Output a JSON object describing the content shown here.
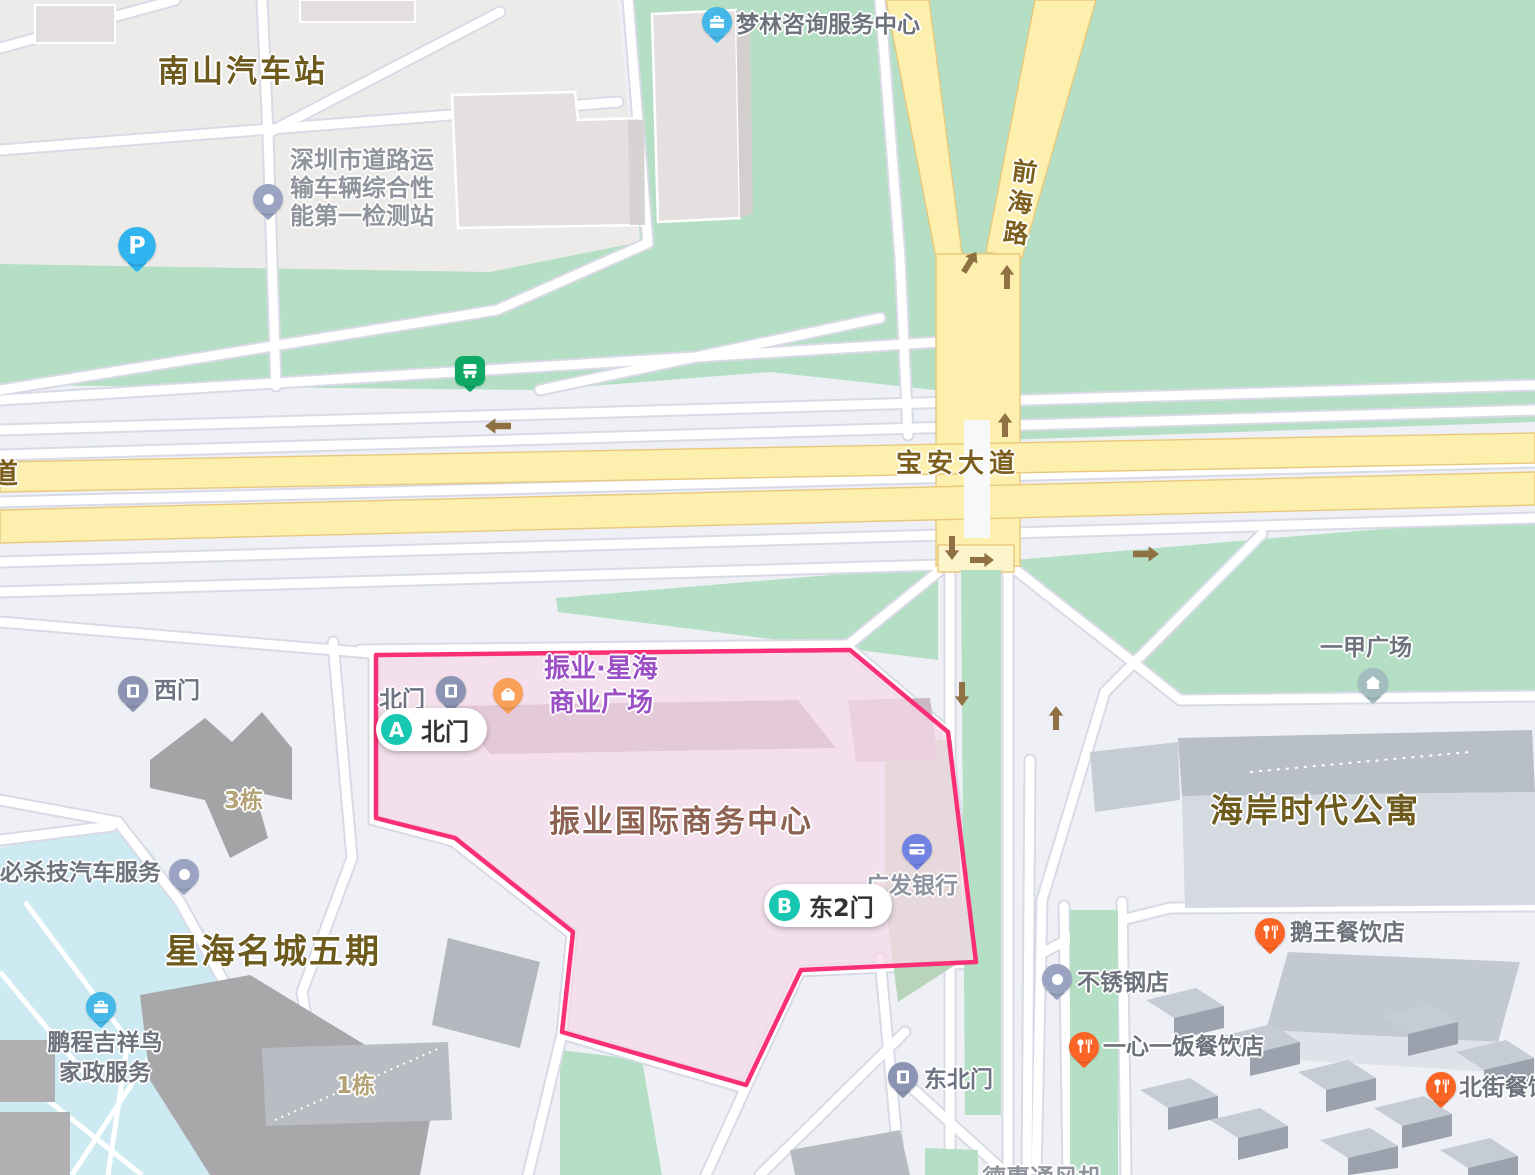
{
  "colors": {
    "polygon_stroke": "#fb2f75",
    "polygon_fill": "#f6d9e7",
    "green": "#b5dfc4",
    "road_yellow": "#fdf0ae",
    "teal_marker": "#17c7b2",
    "water": "#cde9f2"
  },
  "map": {
    "area_labels": {
      "nanshan_bus_station": "南山汽车站",
      "xinghai_mingcheng_phase5": "星海名城五期",
      "haian_times_apartment": "海岸时代公寓",
      "zhenye_intl_business_center": "振业国际商务中心",
      "yijia_plaza": "一甲广场",
      "building_3": "3栋",
      "building_1": "1栋"
    },
    "road_labels": {
      "baoan_avenue": "宝安大道",
      "qianhai_road": "前海路",
      "partial_left_edge": "道"
    },
    "poi_labels": {
      "menglin": "梦林咨询服务中心",
      "inspection_line1": "深圳市道路运",
      "inspection_line2": "输车辆综合性",
      "inspection_line3": "能第一检测站",
      "zhenye_xinghai_line1": "振业·星海",
      "zhenye_xinghai_line2": "商业广场",
      "cgb_bank": "广发银行",
      "bisha_auto": "必杀技汽车服务",
      "pengcheng_line1": "鹏程吉祥鸟",
      "pengcheng_line2": "家政服务",
      "ewang": "鹅王餐饮店",
      "stainless": "不锈钢店",
      "yixinyifan": "一心一饭餐饮店",
      "beijie": "北街餐饮",
      "dehui_partial": "德惠通风机"
    },
    "gate_labels": {
      "north_gate": "北门",
      "west_gate": "西门",
      "northeast_gate": "东北门"
    },
    "route_markers": {
      "a_letter": "A",
      "a_label": "北门",
      "b_letter": "B",
      "b_label": "东2门"
    },
    "parking_glyph": "P"
  }
}
